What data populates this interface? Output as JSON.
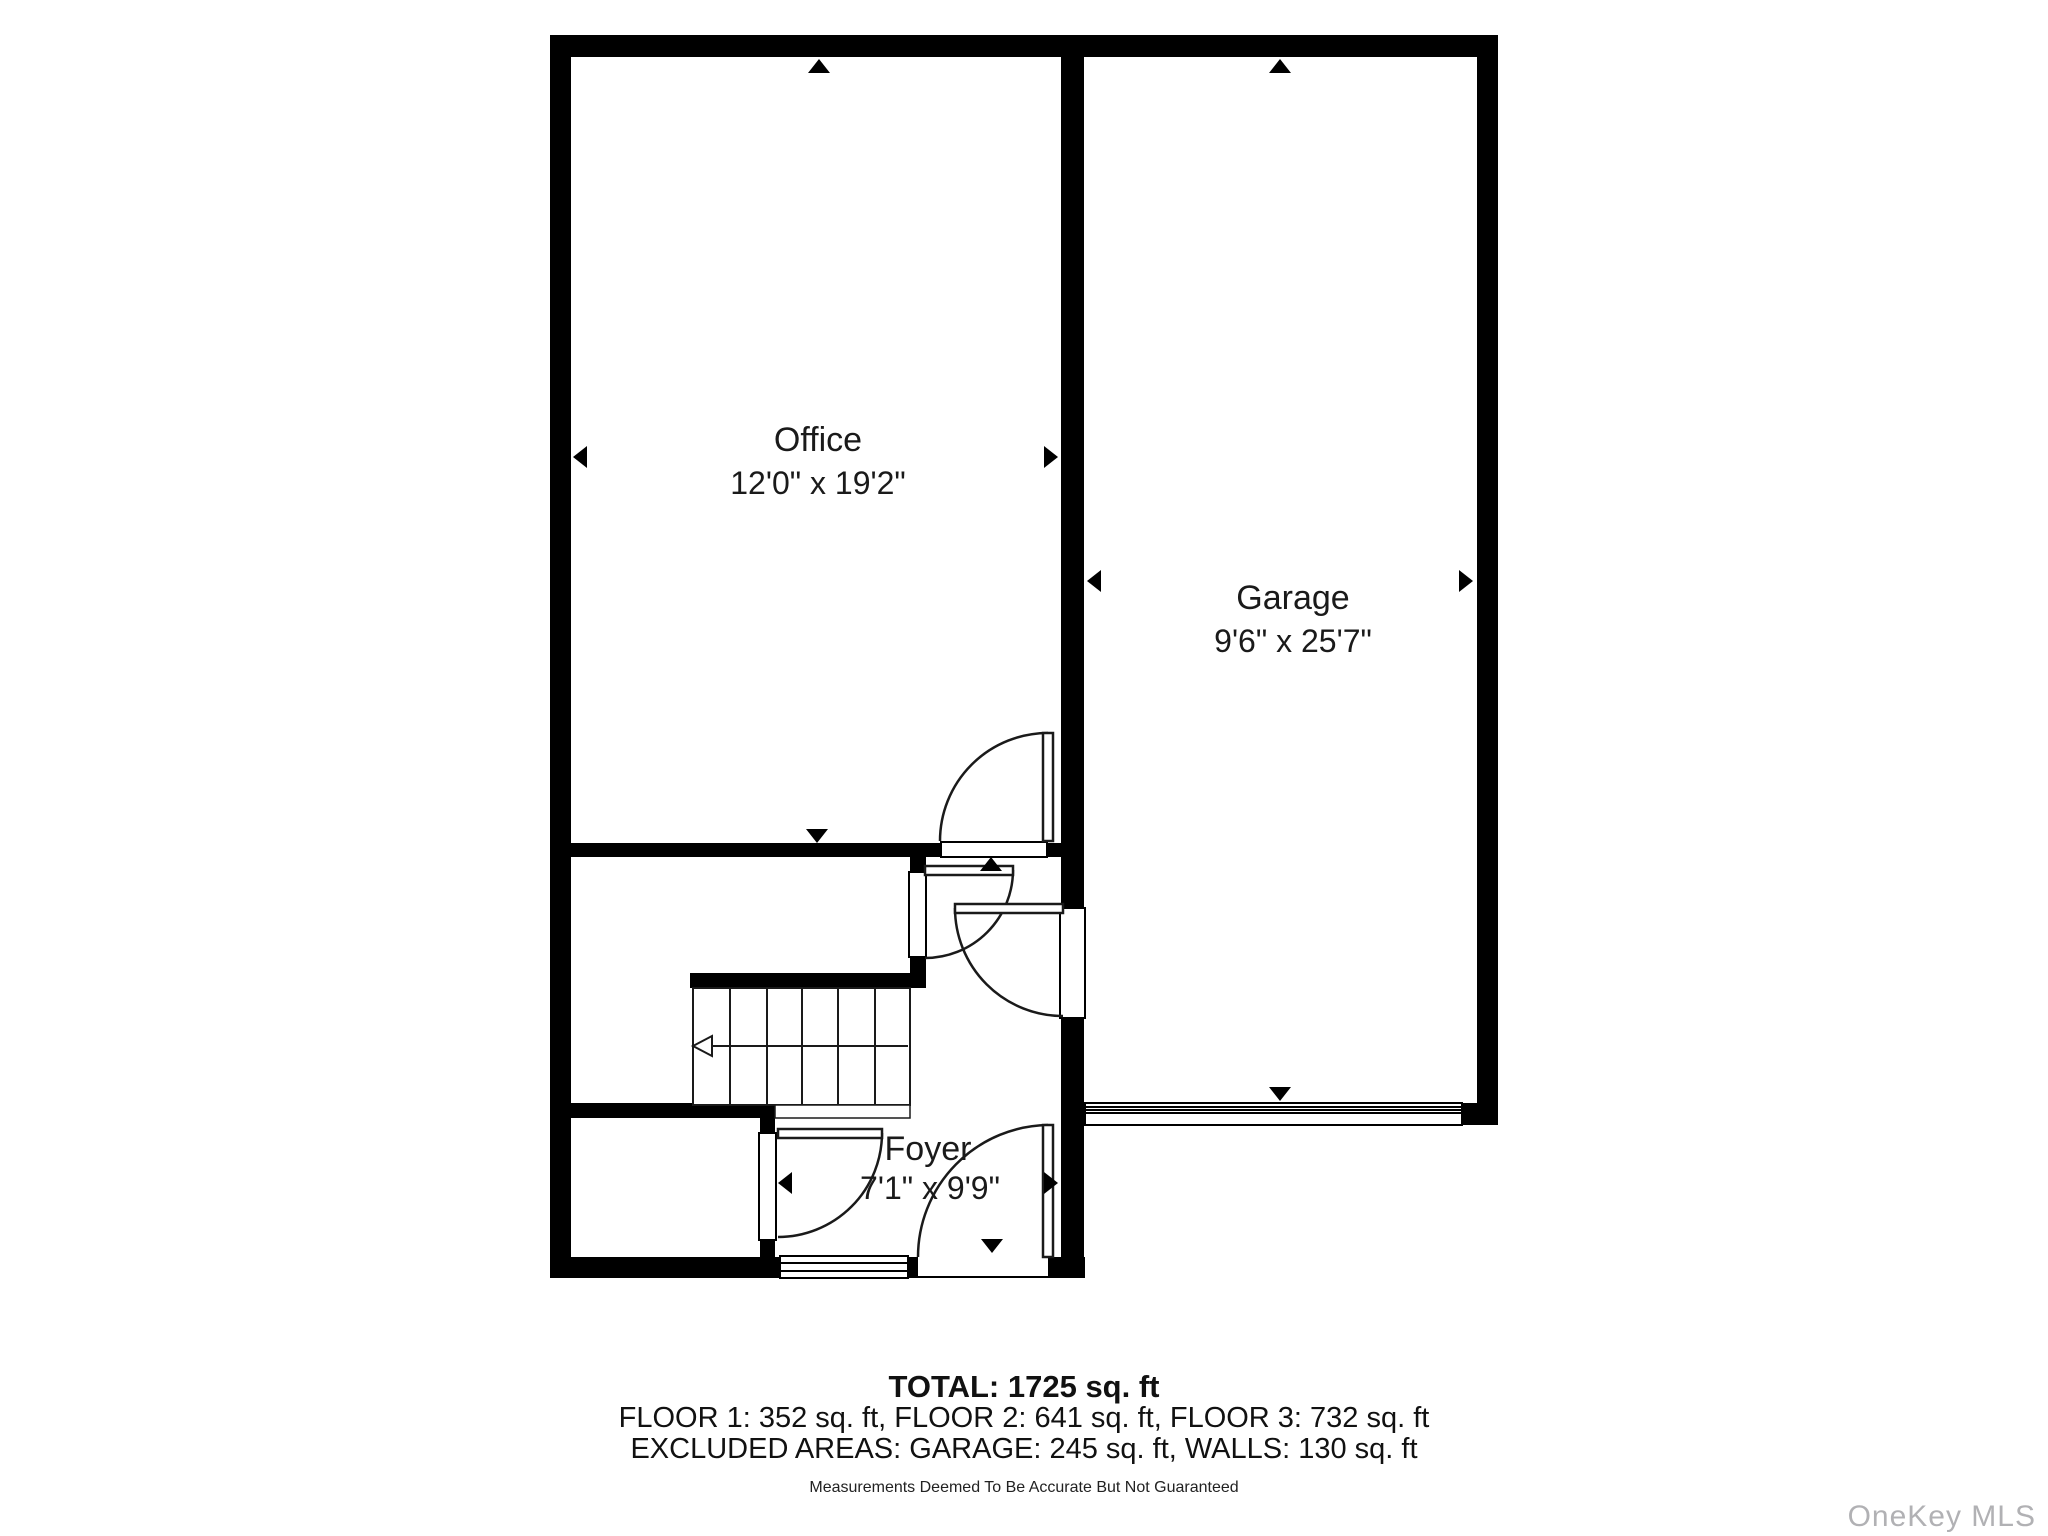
{
  "plan": {
    "rooms": [
      {
        "name": "Office",
        "dims": "12'0\" x 19'2\""
      },
      {
        "name": "Garage",
        "dims": "9'6\" x 25'7\""
      },
      {
        "name": "Foyer",
        "dims": "7'1\" x 9'9\""
      }
    ],
    "summary": {
      "total": "TOTAL: 1725 sq. ft",
      "floors": "FLOOR 1: 352 sq. ft, FLOOR 2: 641 sq. ft, FLOOR 3: 732 sq. ft",
      "excluded": "EXCLUDED AREAS: GARAGE: 245 sq. ft, WALLS: 130 sq. ft",
      "disclaimer": "Measurements Deemed To Be Accurate But Not Guaranteed"
    },
    "watermark": "OneKey MLS",
    "colors": {
      "wall": "#000000",
      "text": "#1a1a1a",
      "watermark": "#b1b1b4"
    }
  }
}
